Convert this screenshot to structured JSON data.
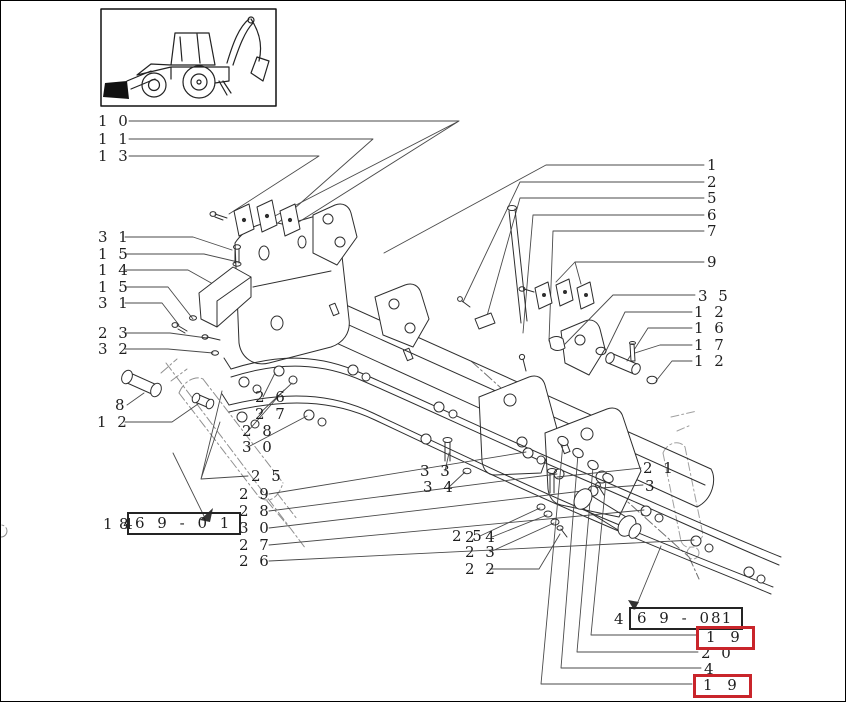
{
  "meta": {
    "description": "Exploded parts diagram of backhoe loader front sub-frame",
    "icons": {
      "thumbnail": "backhoe-loader-side-view-drawing"
    },
    "colors": {
      "highlight_red": "#c9252b",
      "line": "#2e2e2e",
      "phantom": "#9a9a9a"
    }
  },
  "callouts": {
    "c01": "1 0",
    "c02": "1 1",
    "c03": "1 3",
    "c04": "3 1",
    "c05": "1 5",
    "c06": "1 4",
    "c07": "1 5",
    "c08": "3 1",
    "c09": "2 3",
    "c10": "3 2",
    "c11": "8",
    "c12": "1 2",
    "c13": "2 6",
    "c14": "2 7",
    "c15": "2 8",
    "c16": "3 0",
    "c17": "2 5",
    "c18": "2 9",
    "c19": "2 8",
    "c20": "3 0",
    "c21": "2 7",
    "c22": "2 6",
    "c23": "3 3",
    "c24": "3 4",
    "c25": "2 5",
    "c26": "2 4",
    "c27": "2 3",
    "c28": "2 2",
    "c29": "1",
    "c30": "2",
    "c31": "5",
    "c32": "6",
    "c33": "7",
    "c34": "9",
    "c35": "3 5",
    "c36": "1 2",
    "c37": "1 6",
    "c38": "1 7",
    "c39": "1 2",
    "c40": "2 1",
    "c41": "3",
    "c42": "2 0",
    "c43": "4"
  },
  "refs": {
    "left": {
      "prefix": "1 4",
      "adjacent": "8",
      "boxed": "6 9 - 0 1"
    },
    "right": {
      "prefix": "4",
      "boxed": "6 9 - 0 1",
      "suffix": "8"
    }
  },
  "highlights": {
    "h1": "1 9",
    "h2": "1 9"
  }
}
